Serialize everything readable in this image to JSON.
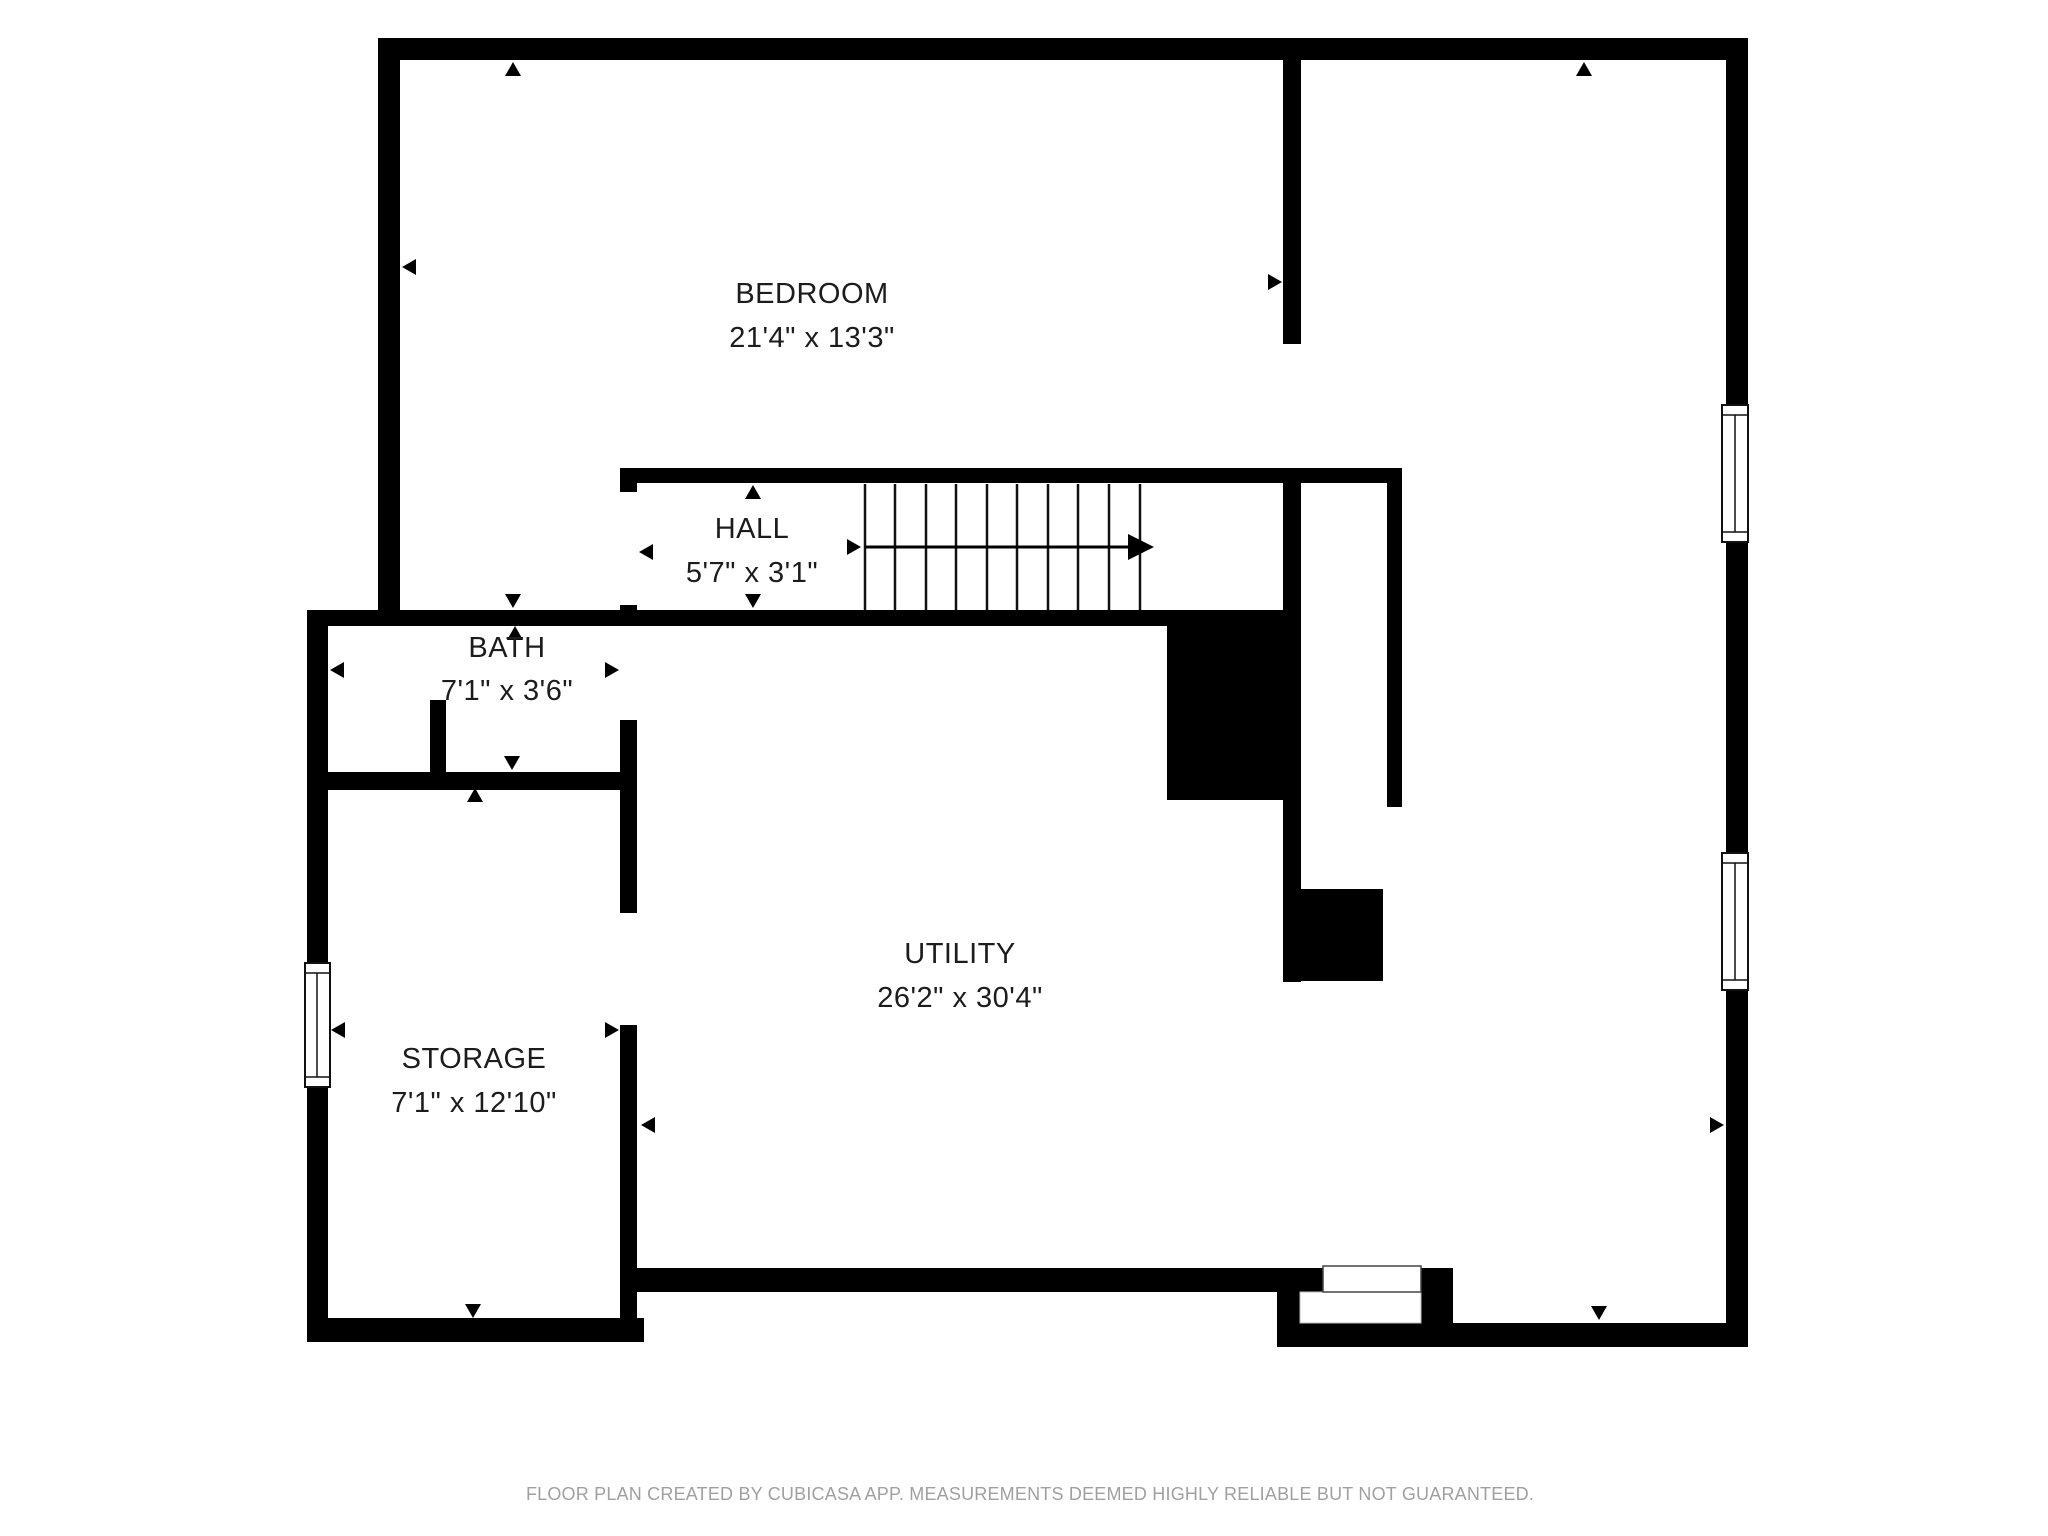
{
  "rooms": [
    {
      "id": "bedroom",
      "name": "BEDROOM",
      "dims": "21'4\" x 13'3\""
    },
    {
      "id": "hall",
      "name": "HALL",
      "dims": "5'7\" x 3'1\""
    },
    {
      "id": "bath",
      "name": "BATH",
      "dims": "7'1\" x 3'6\""
    },
    {
      "id": "storage",
      "name": "STORAGE",
      "dims": "7'1\" x 12'10\""
    },
    {
      "id": "utility",
      "name": "UTILITY",
      "dims": "26'2\" x 30'4\""
    }
  ],
  "footer": {
    "disclaimer": "FLOOR PLAN CREATED BY CUBICASA APP. MEASUREMENTS DEEMED HIGHLY RELIABLE BUT NOT GUARANTEED."
  },
  "colors": {
    "wall": "#000000",
    "background": "#ffffff",
    "label_text": "#1c1c1c",
    "footer_text": "#a0a0a0"
  }
}
